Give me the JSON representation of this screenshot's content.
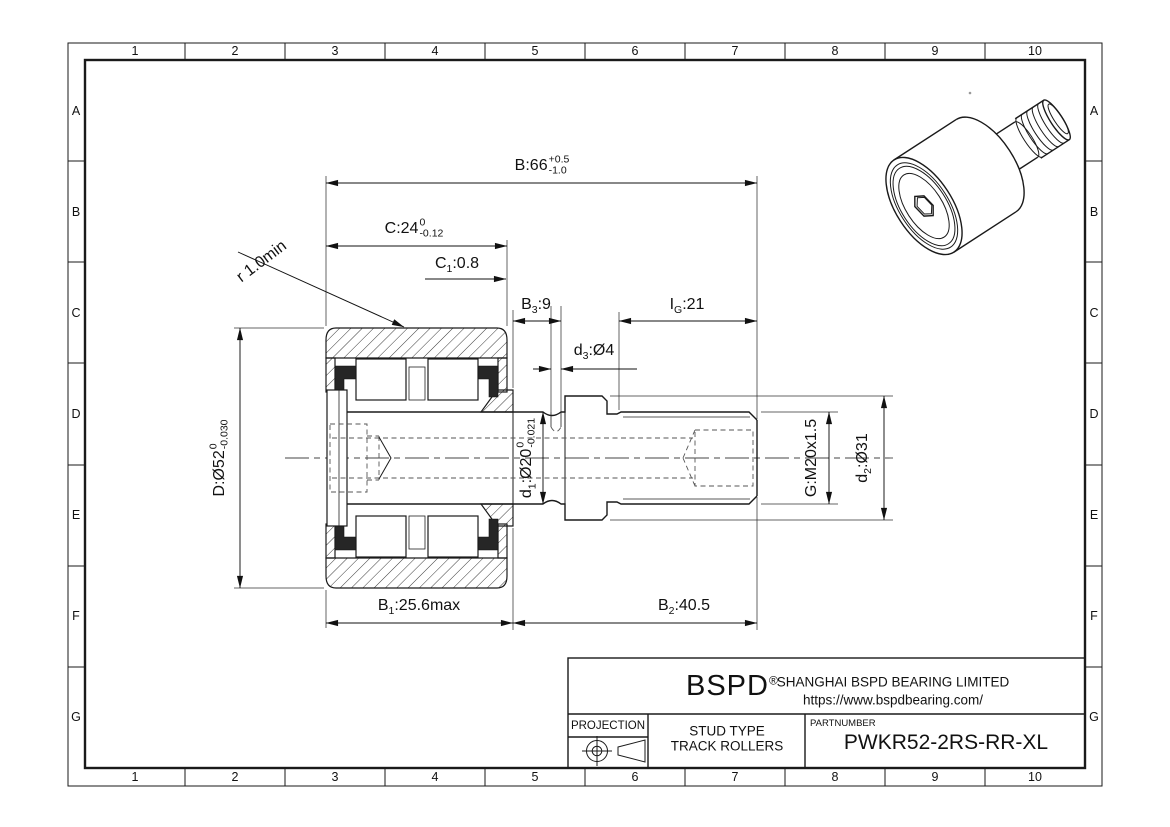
{
  "title_block": {
    "logo": "BSPD",
    "logo_mark": "®",
    "company": "SHANGHAI BSPD BEARING LIMITED",
    "website": "https://www.bspdbearing.com/",
    "projection_label": "PROJECTION",
    "product_type_line1": "STUD TYPE",
    "product_type_line2": "TRACK ROLLERS",
    "partnumber_label": "PARTNUMBER",
    "partnumber": "PWKR52-2RS-RR-XL"
  },
  "grid": {
    "columns": [
      "1",
      "2",
      "3",
      "4",
      "5",
      "6",
      "7",
      "8",
      "9",
      "10"
    ],
    "rows": [
      "A",
      "B",
      "C",
      "D",
      "E",
      "F",
      "G"
    ]
  },
  "dimensions": {
    "B": {
      "pre": "B",
      "val": ":66",
      "tol_up": "+0.5",
      "tol_dn": "-1.0"
    },
    "C": {
      "pre": "C",
      "val": ":24",
      "tol_up": "0",
      "tol_dn": "-0.12"
    },
    "C1": {
      "pre": "C",
      "sub": "1",
      "val": ":0.8"
    },
    "B3": {
      "pre": "B",
      "sub": "3",
      "val": ":9"
    },
    "IG": {
      "pre": "I",
      "sub": "G",
      "val": ":21"
    },
    "d3": {
      "pre": "d",
      "sub": "3",
      "val": ":Ø4"
    },
    "r": {
      "pre": "r 1.0min"
    },
    "D": {
      "pre": "D",
      "val": ":Ø52",
      "tol_up": "0",
      "tol_dn": "-0.030"
    },
    "d1": {
      "pre": "d",
      "sub": "1",
      "val": ":Ø20",
      "tol_up": "0",
      "tol_dn": "-0.021"
    },
    "G": {
      "pre": "G",
      "val": ":M20x1.5"
    },
    "d2": {
      "pre": "d",
      "sub": "2",
      "val": ":Ø31"
    },
    "B1": {
      "pre": "B",
      "sub": "1",
      "val": ":25.6max"
    },
    "B2": {
      "pre": "B",
      "sub": "2",
      "val": ":40.5"
    }
  },
  "colors": {
    "line": "#1a1a1a",
    "background": "#ffffff",
    "seal": "#262626"
  }
}
